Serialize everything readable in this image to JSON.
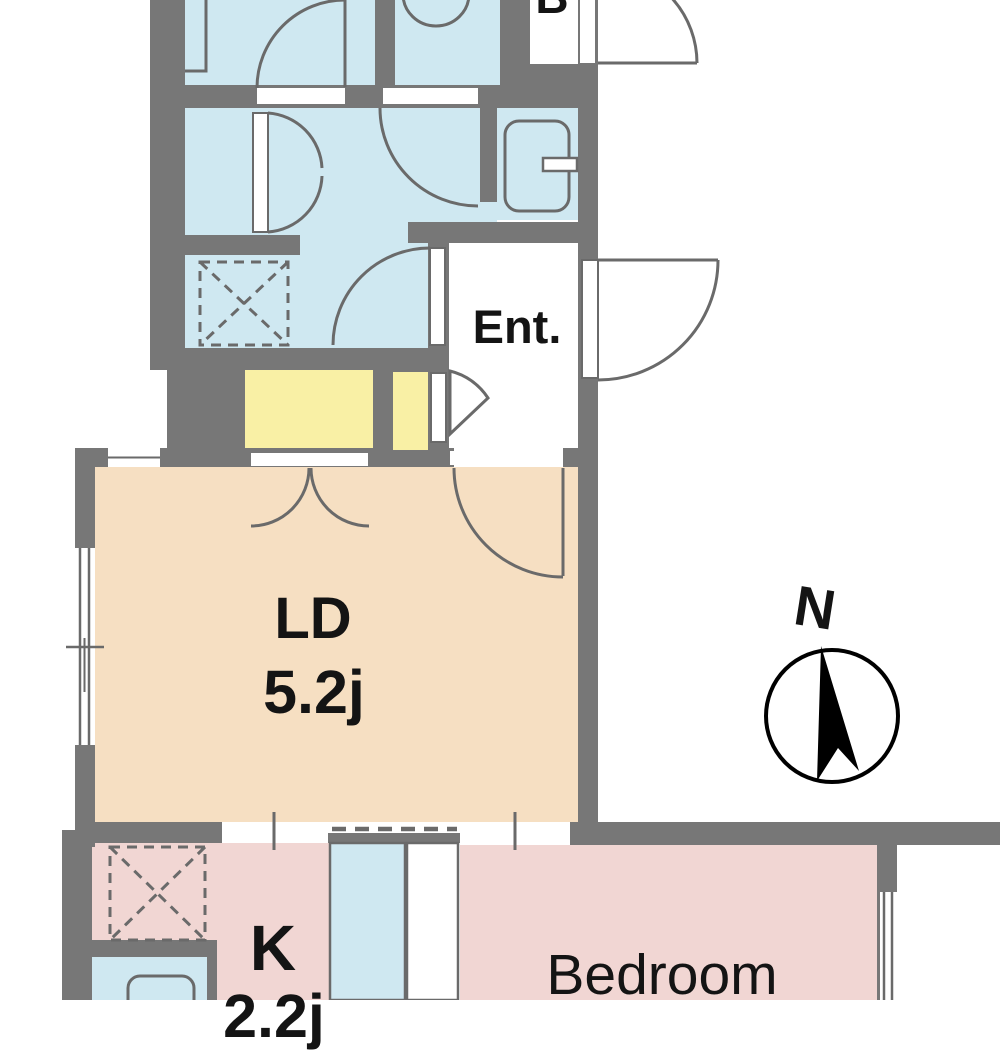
{
  "plan": {
    "rooms": {
      "living_dining": {
        "label": "LD",
        "size": "5.2j"
      },
      "kitchen": {
        "label": "K",
        "size": "2.2j"
      },
      "bedroom": {
        "label": "Bedroom"
      },
      "entrance": {
        "label": "Ent."
      },
      "bath": {
        "label": "B"
      }
    },
    "compass": {
      "label": "N"
    },
    "palette": {
      "wall_gray": "#777777",
      "line_gray": "#6a6a6a",
      "water_room_blue": "#cfe8f1",
      "living_peach": "#f6dfc2",
      "bedroom_pink": "#f1d6d3",
      "counter_yellow": "#f9f0a5",
      "label_text": "#141414",
      "compass_black": "#000000"
    }
  }
}
